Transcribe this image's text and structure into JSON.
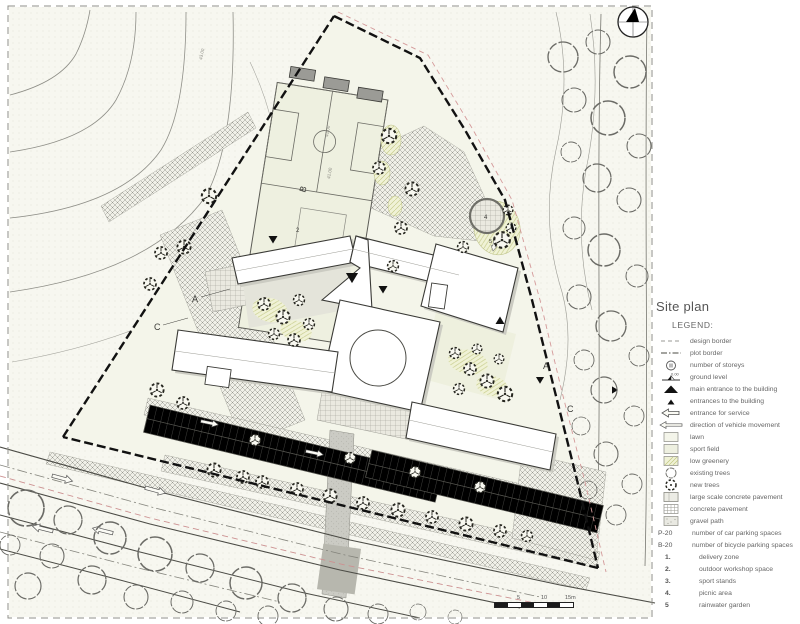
{
  "panel": {
    "title": "Site plan",
    "legend_heading": "LEGEND:",
    "ground_level_value": "0.00",
    "items": [
      {
        "key": "design-border",
        "label": "design border"
      },
      {
        "key": "plot-border",
        "label": "plot border"
      },
      {
        "key": "storeys",
        "label": "number of storeys"
      },
      {
        "key": "ground-level",
        "label": "ground level"
      },
      {
        "key": "main-entrance",
        "label": "main entrance to the building"
      },
      {
        "key": "entrances",
        "label": "entrances to the building"
      },
      {
        "key": "service-entrance",
        "label": "entrance for service"
      },
      {
        "key": "vehicle-direction",
        "label": "direction of vehicle movement"
      },
      {
        "key": "lawn",
        "label": "lawn"
      },
      {
        "key": "sport-field",
        "label": "sport field"
      },
      {
        "key": "low-greenery",
        "label": "low greenery"
      },
      {
        "key": "existing-trees",
        "label": "existing trees"
      },
      {
        "key": "new-trees",
        "label": "new trees"
      },
      {
        "key": "large-concrete",
        "label": "large scale concrete pavement"
      },
      {
        "key": "concrete",
        "label": "concrete pavement"
      },
      {
        "key": "gravel",
        "label": "gravel path"
      },
      {
        "key": "car-parking",
        "prefix": "P-20",
        "label": "number of car parking spaces"
      },
      {
        "key": "bike-parking",
        "prefix": "B-20",
        "label": "number of bicycle parking spaces"
      },
      {
        "key": "delivery",
        "prefix": "1.",
        "label": "delivery zone"
      },
      {
        "key": "workshop",
        "prefix": "2.",
        "label": "outdoor workshop space"
      },
      {
        "key": "stands",
        "prefix": "3.",
        "label": "sport stands"
      },
      {
        "key": "picnic",
        "prefix": "4.",
        "label": "picnic area"
      },
      {
        "key": "rainwater",
        "prefix": "5",
        "label": "rainwater garden"
      }
    ]
  },
  "scale_bar": {
    "tick1": "5",
    "tick2": "10",
    "tick3": "15m"
  },
  "plan": {
    "building_labels": {
      "a_west": "A",
      "b_field": "B",
      "c_west": "C",
      "a_east": "A",
      "c_east": "C"
    },
    "area_numbers": {
      "workshop": "2",
      "picnic": "4",
      "rainwater": "5"
    },
    "contour_labels": {
      "c1": "43.00",
      "c2": "41.00",
      "c3": "41.00"
    }
  }
}
